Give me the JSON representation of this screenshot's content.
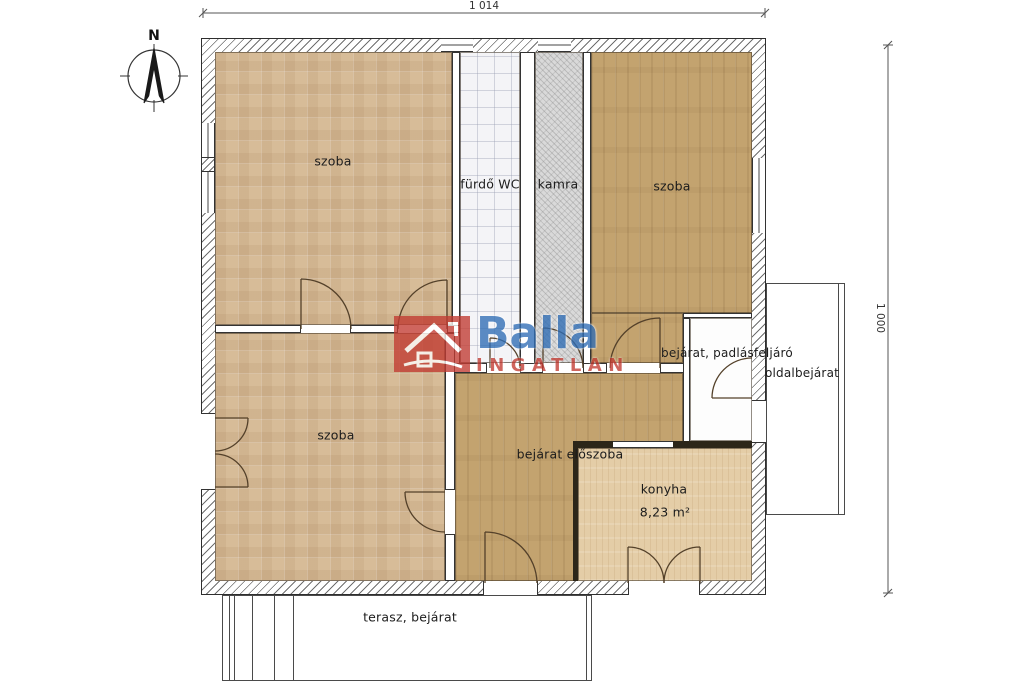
{
  "floorplan": {
    "compass": {
      "label": "N"
    },
    "dimensions": {
      "width_label": "1 014",
      "height_label": "1 000"
    },
    "labels": {
      "room_nw": "szoba",
      "bathroom": "fürdő WC",
      "pantry": "kamra",
      "room_ne": "szoba",
      "room_sw": "szoba",
      "hall": "bejárat előszoba",
      "entry_attic": "bejárat, padlásfeljáró",
      "side_entrance": "oldalbejárat",
      "kitchen": "konyha",
      "kitchen_area": "8,23 m²",
      "terrace": "terasz, bejárat"
    },
    "watermark": {
      "brand": "Balla",
      "subtitle": "INGATLAN"
    },
    "colors": {
      "parquet_floor": "#d7bc98",
      "plank_wood_floor": "#c3a36f",
      "kitchen_floor": "#e4cda7",
      "bathroom_floor": "#f4f4f7",
      "pantry_floor": "#d9d9d9",
      "wall_outline": "#2e2e2e",
      "watermark_blue": "#2f6db5",
      "watermark_red": "#c23b32"
    }
  }
}
